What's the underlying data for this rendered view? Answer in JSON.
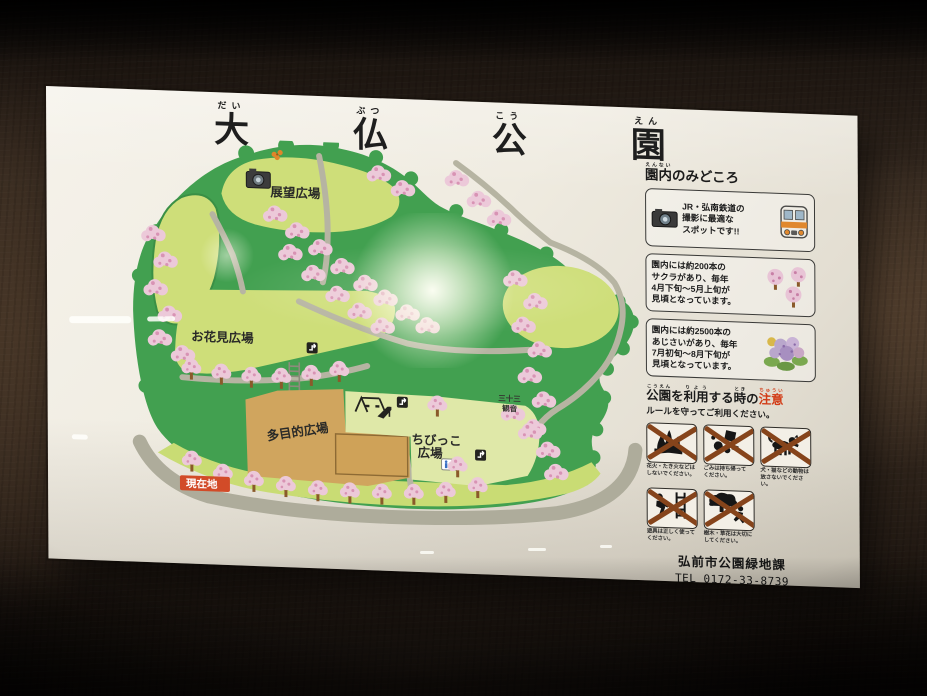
{
  "title": {
    "c1": {
      "k": "大",
      "f": "だい"
    },
    "c2": {
      "k": "仏",
      "f": "ぶつ"
    },
    "c3": {
      "k": "公",
      "f": "こう"
    },
    "c4": {
      "k": "園",
      "f": "えん"
    }
  },
  "map": {
    "labels": {
      "tenbo": "展望広場",
      "ohanami": "お花見広場",
      "tamokuteki": "多目的広場",
      "chibikko_1": "ちびっこ",
      "chibikko_2": "広場",
      "kannon_1": "三十三",
      "kannon_2": "観音",
      "genzaichi": "現在地"
    }
  },
  "sidebar": {
    "header": {
      "base": "園内",
      "furigana": "えんない",
      "rest": "のみどころ"
    },
    "photo_spot": {
      "lines": [
        "JR・弘南鉄道の",
        "撮影に最適な",
        "スポットです!!"
      ],
      "furigana": {
        "弘南鉄道": "こうなんてつどう",
        "撮影": "さつえい",
        "最適": "さいてき"
      }
    },
    "sakura": {
      "lines": [
        "園内には約200本の",
        "サクラがあり、毎年",
        "4月下旬～5月上旬が",
        "見頃となっています。"
      ],
      "furigana": {
        "園内": "えんない",
        "毎年": "まいとし",
        "見頃": "みごろ"
      }
    },
    "ajisai": {
      "lines": [
        "園内には約2500本の",
        "あじさいがあり、毎年",
        "7月初旬～8月下旬が",
        "見頃となっています。"
      ],
      "furigana": {
        "園内": "えんない",
        "毎年": "まいとし",
        "見頃": "みごろ"
      }
    },
    "notice": {
      "w1": {
        "t": "公園",
        "f": "こうえん"
      },
      "w2": {
        "t": "を"
      },
      "w3": {
        "t": "利用",
        "f": "りよう"
      },
      "w4": {
        "t": "する"
      },
      "w5": {
        "t": "時",
        "f": "とき"
      },
      "w6": {
        "t": "の"
      },
      "w7": {
        "t": "注意",
        "f": "ちゅうい"
      },
      "subtitle": "ルールを守ってご利用ください。",
      "rules": [
        {
          "icon": "no-fire-icon",
          "line1": "花火・たき火などは",
          "line2": "しないでください。"
        },
        {
          "icon": "take-trash-home-icon",
          "line1": "ごみは持ち帰って",
          "line2": "ください。"
        },
        {
          "icon": "no-stray-pets-icon",
          "line1": "犬・猫などの動物は",
          "line2": "放さないでください。"
        },
        {
          "icon": "use-equipment-properly-icon",
          "line1": "遊具は正しく使って",
          "line2": "ください。"
        },
        {
          "icon": "protect-plants-icon",
          "line1": "樹木・草花は大切に",
          "line2": "してください。"
        }
      ]
    },
    "footer": {
      "org": "弘前市公園緑地課",
      "tel": "TEL 0172-33-8739"
    }
  },
  "colors": {
    "park_green": "#42a050",
    "plaza_green": "#cede79",
    "pale_green": "#dfe8a8",
    "ground_tan": "#d0a55e",
    "road_gray": "#aeac9b",
    "sakura_pink": "#ecc9d9",
    "sakura_dot": "#d893b4",
    "marker_red": "#d24b28",
    "notice_red": "#d23c17",
    "sign_white": "#efebe0"
  }
}
